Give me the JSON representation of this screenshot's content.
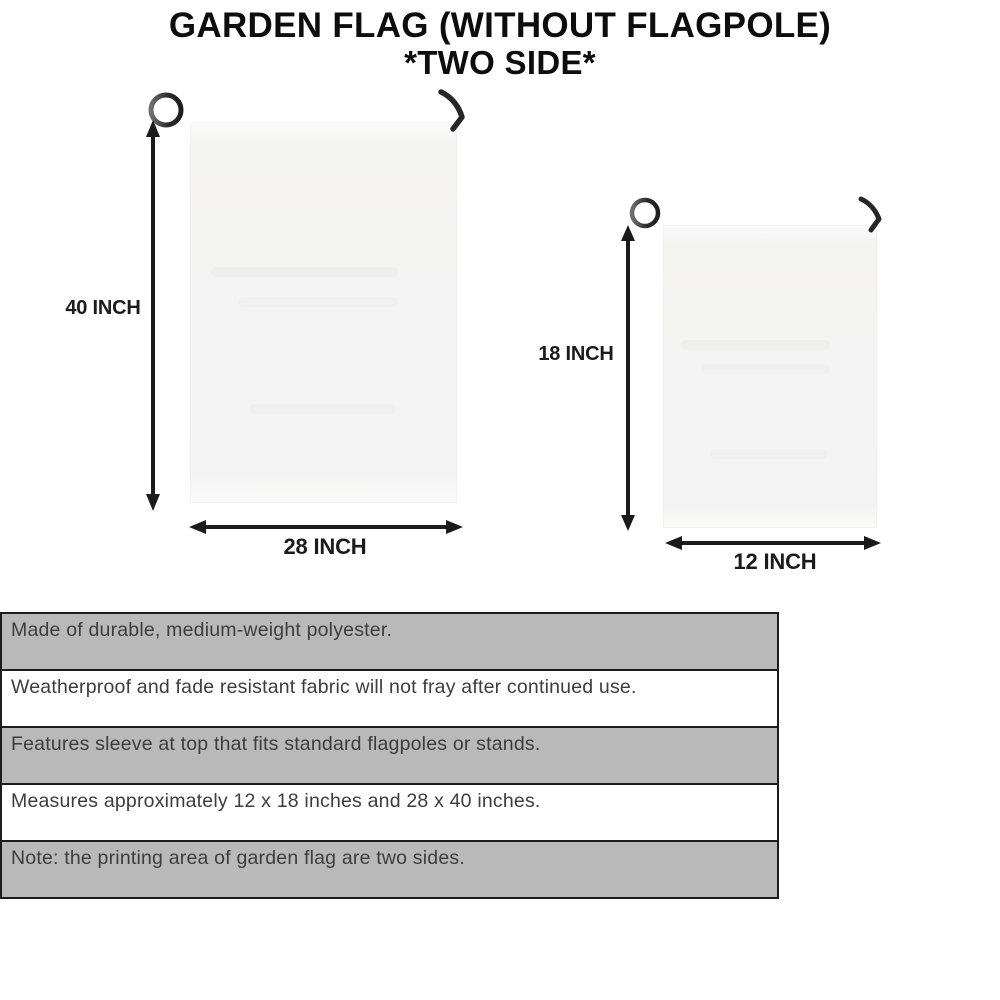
{
  "title": {
    "line1": "GARDEN FLAG (WITHOUT FLAGPOLE)",
    "line2": "*TWO SIDE*"
  },
  "flags": {
    "large": {
      "height_label": "40 INCH",
      "width_label": "28 INCH"
    },
    "small": {
      "height_label": "18 INCH",
      "width_label": "12 INCH"
    }
  },
  "features": [
    "Made of durable, medium-weight polyester.",
    "Weatherproof and fade resistant fabric will not fray after continued use.",
    "Features sleeve at top that fits standard flagpoles or stands.",
    "Measures approximately 12 x 18 inches and 28 x 40 inches.",
    "Note: the printing area of garden flag are two sides."
  ],
  "colors": {
    "row_gray": "#b9b9b9",
    "row_border": "#1c1c1c",
    "row_text": "#3d3d3d",
    "title_text": "#0d0d0d",
    "arrow": "#1b1b1b",
    "pole_metal": "#3a3a3a",
    "flag_fabric": "#f5f4f4",
    "background": "#ffffff"
  }
}
